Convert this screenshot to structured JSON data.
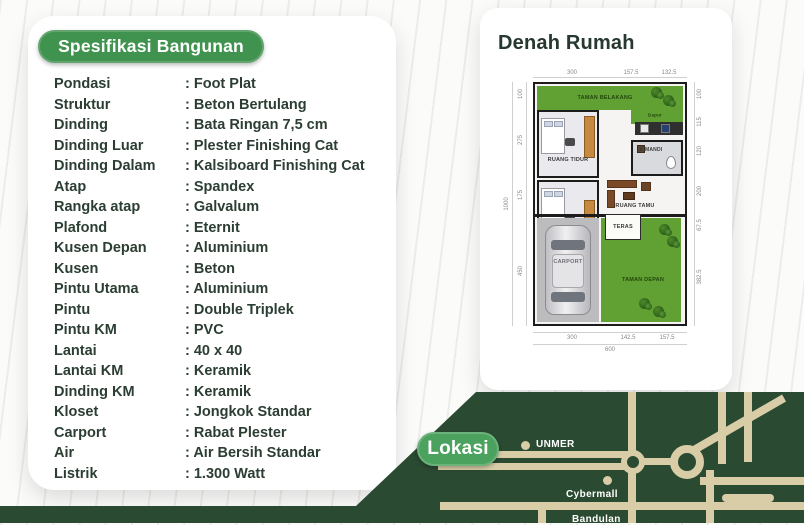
{
  "colors": {
    "accent_green": "#40924f",
    "dark_green": "#2b4a32",
    "road_beige": "#d9cda8",
    "lokasi_green": "#4ba25e",
    "garden_green": "#61a033"
  },
  "spec": {
    "badge_label": "Spesifikasi Bangunan",
    "rows": [
      {
        "label": "Pondasi",
        "value": "Foot Plat"
      },
      {
        "label": "Struktur",
        "value": "Beton Bertulang"
      },
      {
        "label": "Dinding",
        "value": "Bata Ringan 7,5 cm"
      },
      {
        "label": "Dinding Luar",
        "value": "Plester Finishing Cat"
      },
      {
        "label": "Dinding Dalam",
        "value": "Kalsiboard Finishing Cat"
      },
      {
        "label": "Atap",
        "value": "Spandex"
      },
      {
        "label": "Rangka atap",
        "value": "Galvalum"
      },
      {
        "label": "Plafond",
        "value": "Eternit"
      },
      {
        "label": "Kusen Depan",
        "value": "Aluminium"
      },
      {
        "label": "Kusen",
        "value": "Beton"
      },
      {
        "label": "Pintu Utama",
        "value": "Aluminium"
      },
      {
        "label": "Pintu",
        "value": "Double Triplek"
      },
      {
        "label": "Pintu KM",
        "value": "PVC"
      },
      {
        "label": "Lantai",
        "value": "40 x 40"
      },
      {
        "label": "Lantai KM",
        "value": "Keramik"
      },
      {
        "label": "Dinding KM",
        "value": "Keramik"
      },
      {
        "label": "Kloset",
        "value": "Jongkok Standar"
      },
      {
        "label": "Carport",
        "value": "Rabat Plester"
      },
      {
        "label": "Air",
        "value": "Air Bersih Standar"
      },
      {
        "label": "Listrik",
        "value": "1.300 Watt"
      }
    ]
  },
  "plan": {
    "title": "Denah Rumah",
    "rooms": {
      "taman_belakang": "TAMAN BELAKANG",
      "dapur": "Dapur",
      "tidur1": "RUANG TIDUR",
      "tidur2": "RUANG TIDUR",
      "kmandi": "K.MANDI",
      "tamu": "RUANG TAMU",
      "teras": "TERAS",
      "carport": "CARPORT",
      "taman_depan": "TAMAN DEPAN"
    },
    "dims": {
      "top": [
        "300",
        "157.5",
        "132.5"
      ],
      "bottom": [
        "300",
        "142.5",
        "157.5"
      ],
      "bottom_total": "600",
      "left": [
        "100",
        "275",
        "175",
        "450"
      ],
      "left_total": "1000",
      "right": [
        "100",
        "115",
        "120",
        "200",
        "67.5",
        "382.5"
      ]
    }
  },
  "location": {
    "badge_label": "Lokasi",
    "markers": {
      "unmer": "UNMER",
      "cybermall": "Cybermall",
      "bandulan": "Bandulan"
    }
  }
}
